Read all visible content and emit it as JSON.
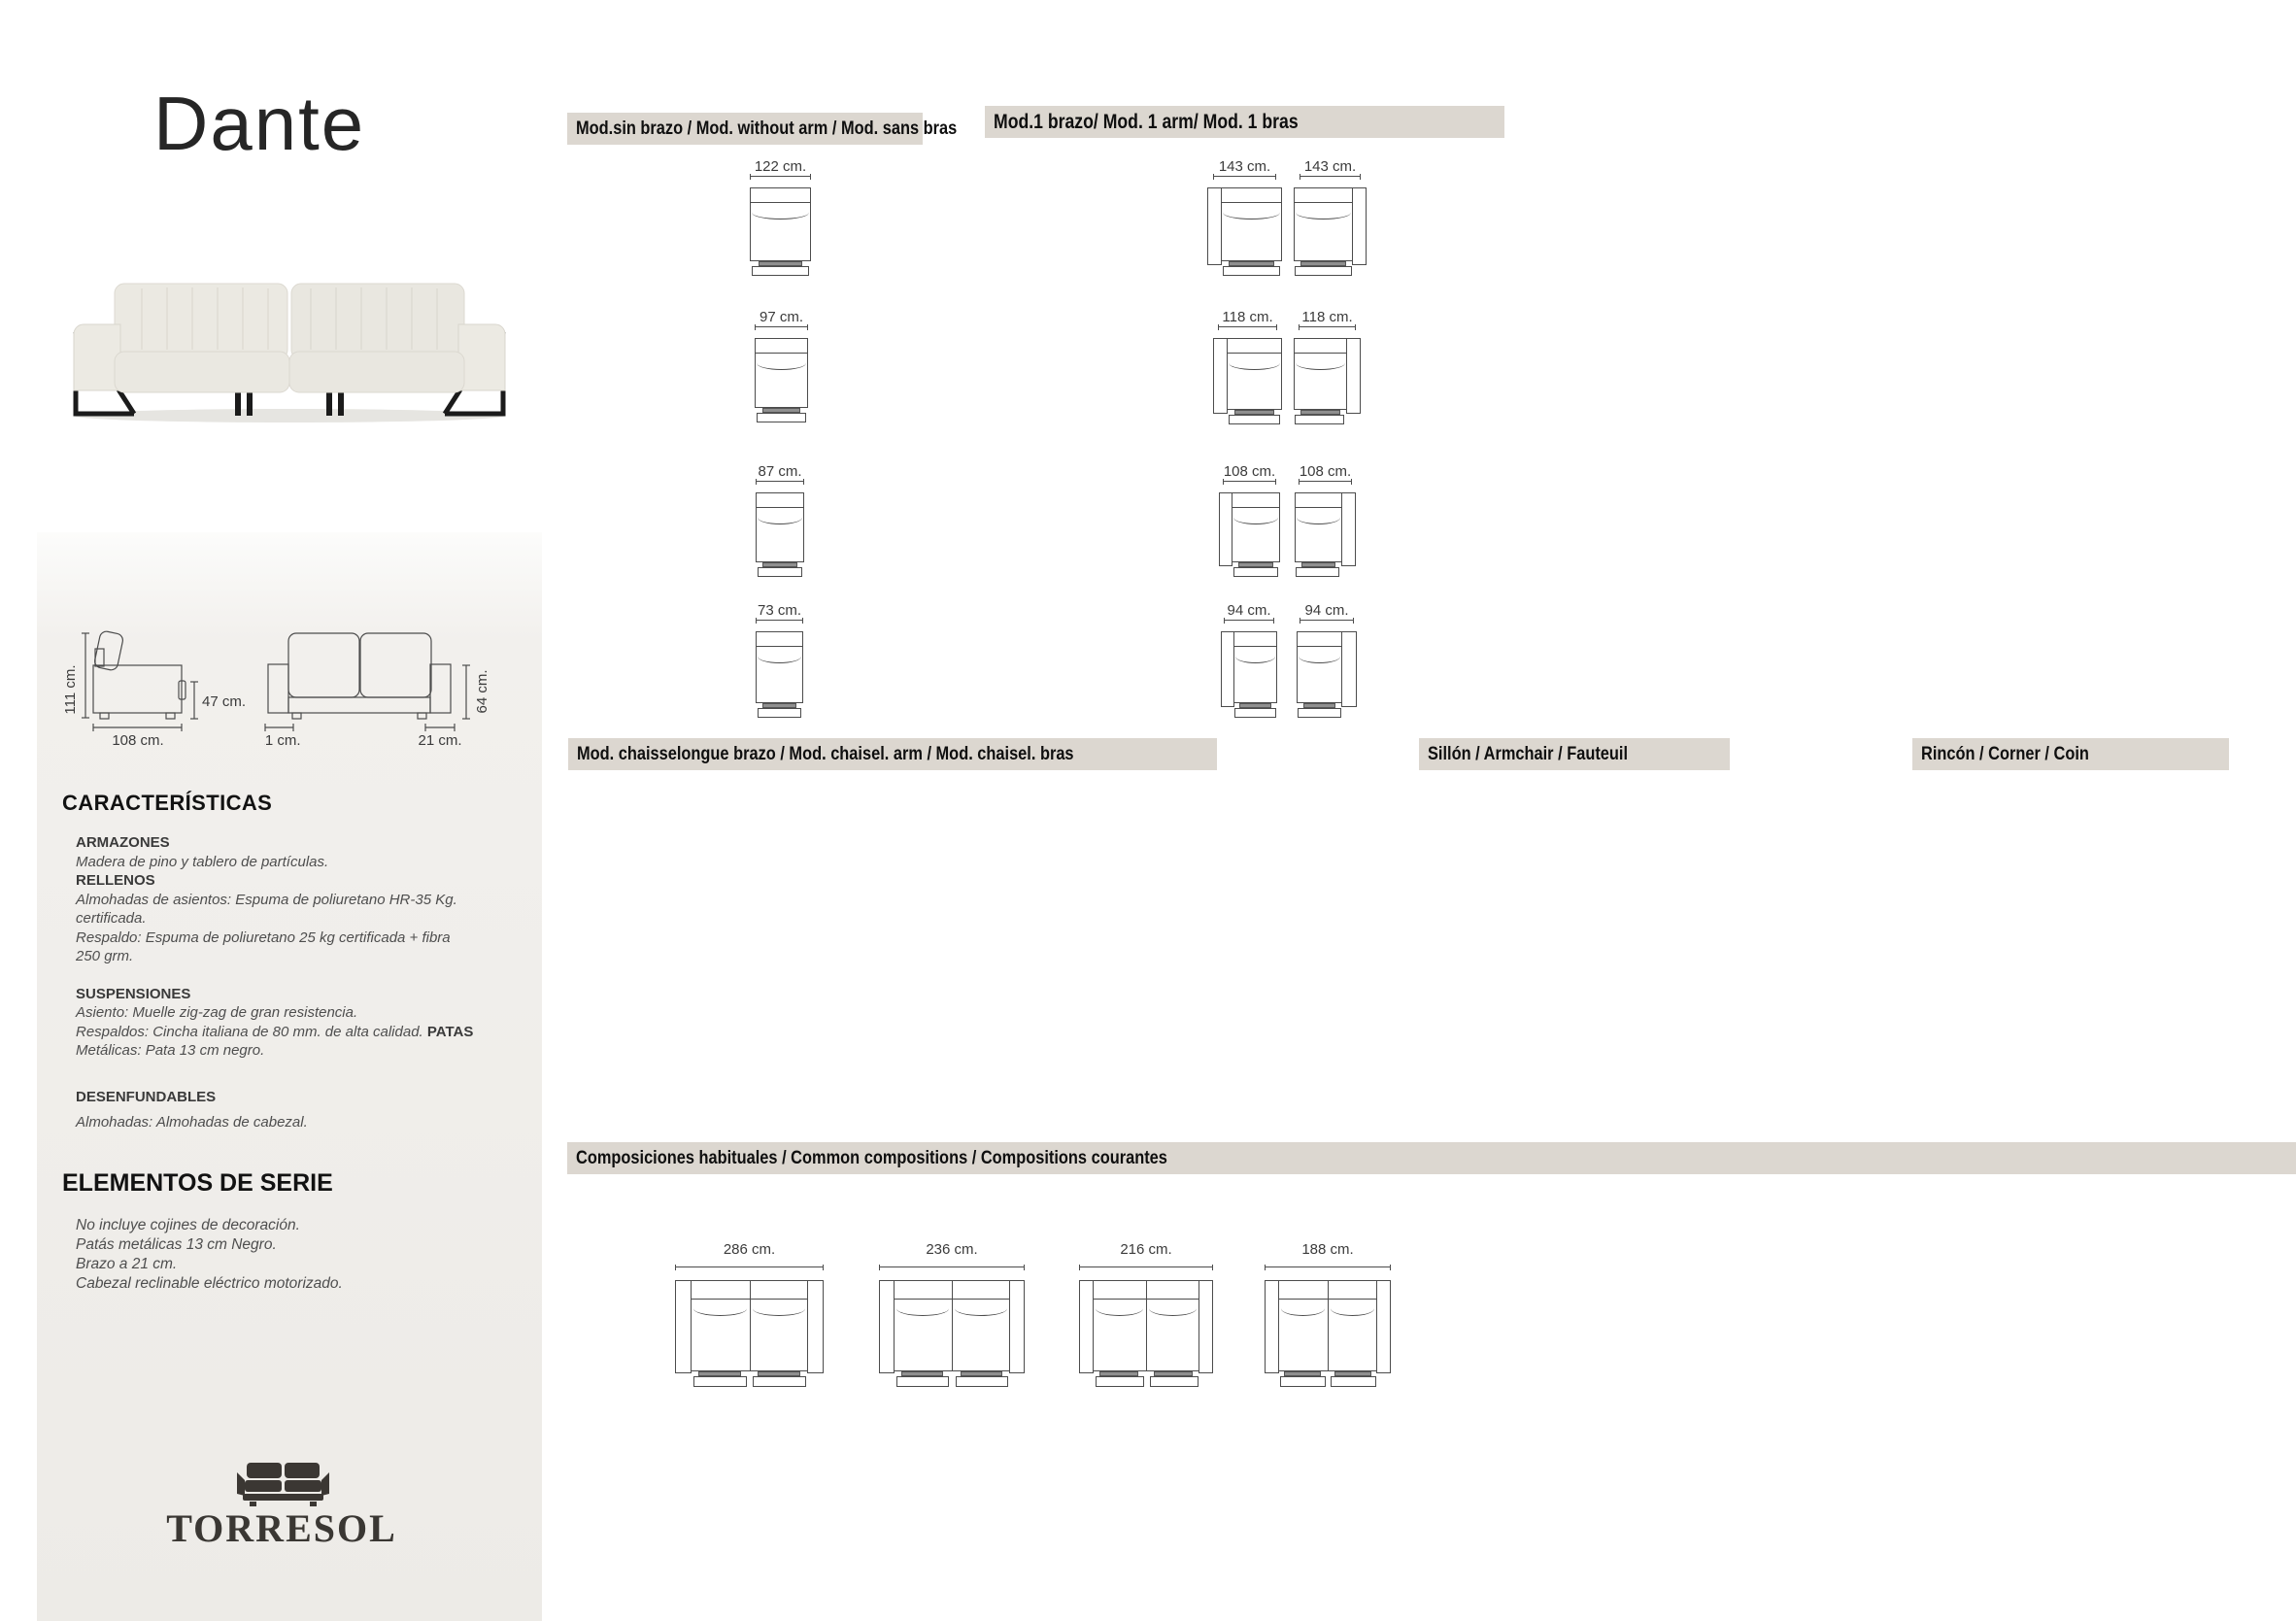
{
  "title": "Dante",
  "logo": {
    "text": "TORRESOL",
    "icon": "sofa-silhouette"
  },
  "colors": {
    "header_bg": "#dcd7d0",
    "panel_bg": "#edebe7",
    "diagram_line": "#4c4c4c",
    "body_text": "#4e4e4e",
    "logo_color": "#3a3733"
  },
  "spec_diagram": {
    "side_height": "111 cm.",
    "side_depth": "108 cm.",
    "seat_height": "47 cm.",
    "arm_width_left": "21 cm.",
    "arm_width_right": "21 cm.",
    "back_height": "64 cm."
  },
  "characteristics": {
    "heading": "CARACTERÍSTICAS",
    "blocks": [
      {
        "label": "ARMAZONES",
        "lines": [
          "Madera de pino y tablero de partículas."
        ]
      },
      {
        "label": "RELLENOS",
        "lines": [
          "Almohadas de asientos: Espuma de poliuretano HR-35 Kg.",
          "certificada.",
          "Respaldo: Espuma de poliuretano 25 kg certificada + fibra",
          "250 grm."
        ]
      },
      {
        "label": "SUSPENSIONES",
        "line1": "Asiento: Muelle zig-zag de gran resistencia.",
        "line2": "Respaldos: Cincha italiana de 80 mm. de alta calidad.",
        "line2_bold": "PATAS",
        "line3": "Metálicas: Pata 13 cm negro."
      },
      {
        "label": "DESENFUNDABLES",
        "lines": [
          "Almohadas: Almohadas de cabezal."
        ]
      }
    ]
  },
  "series": {
    "heading": "ELEMENTOS DE SERIE",
    "lines": [
      "No incluye cojines de decoración.",
      "Patás metálicas 13 cm Negro.",
      "Brazo a 21 cm.",
      "Cabezal reclinable eléctrico motorizado."
    ]
  },
  "sections": {
    "no_arm": {
      "header": "Mod.sin brazo / Mod. without arm / Mod. sans bras",
      "modules": [
        {
          "size": "122 cm."
        },
        {
          "size": "97 cm."
        },
        {
          "size": "87 cm."
        },
        {
          "size": "73 cm."
        }
      ]
    },
    "one_arm": {
      "header": "Mod.1 brazo/ Mod. 1 arm/ Mod. 1 bras",
      "rows": [
        {
          "left": "143 cm.",
          "right": "143 cm."
        },
        {
          "left": "118 cm.",
          "right": "118 cm."
        },
        {
          "left": "108 cm.",
          "right": "108 cm."
        },
        {
          "left": "94 cm.",
          "right": "94 cm."
        }
      ]
    },
    "chaise": {
      "header": "Mod. chaisselongue brazo / Mod. chaisel. arm / Mod. chaisel. bras"
    },
    "armchair": {
      "header": "Sillón / Armchair / Fauteuil"
    },
    "corner": {
      "header": "Rincón / Corner / Coin"
    },
    "compositions": {
      "header": "Composiciones habituales / Common compositions / Compositions courantes",
      "items": [
        {
          "size": "286 cm."
        },
        {
          "size": "236 cm."
        },
        {
          "size": "216 cm."
        },
        {
          "size": "188 cm."
        }
      ]
    }
  }
}
